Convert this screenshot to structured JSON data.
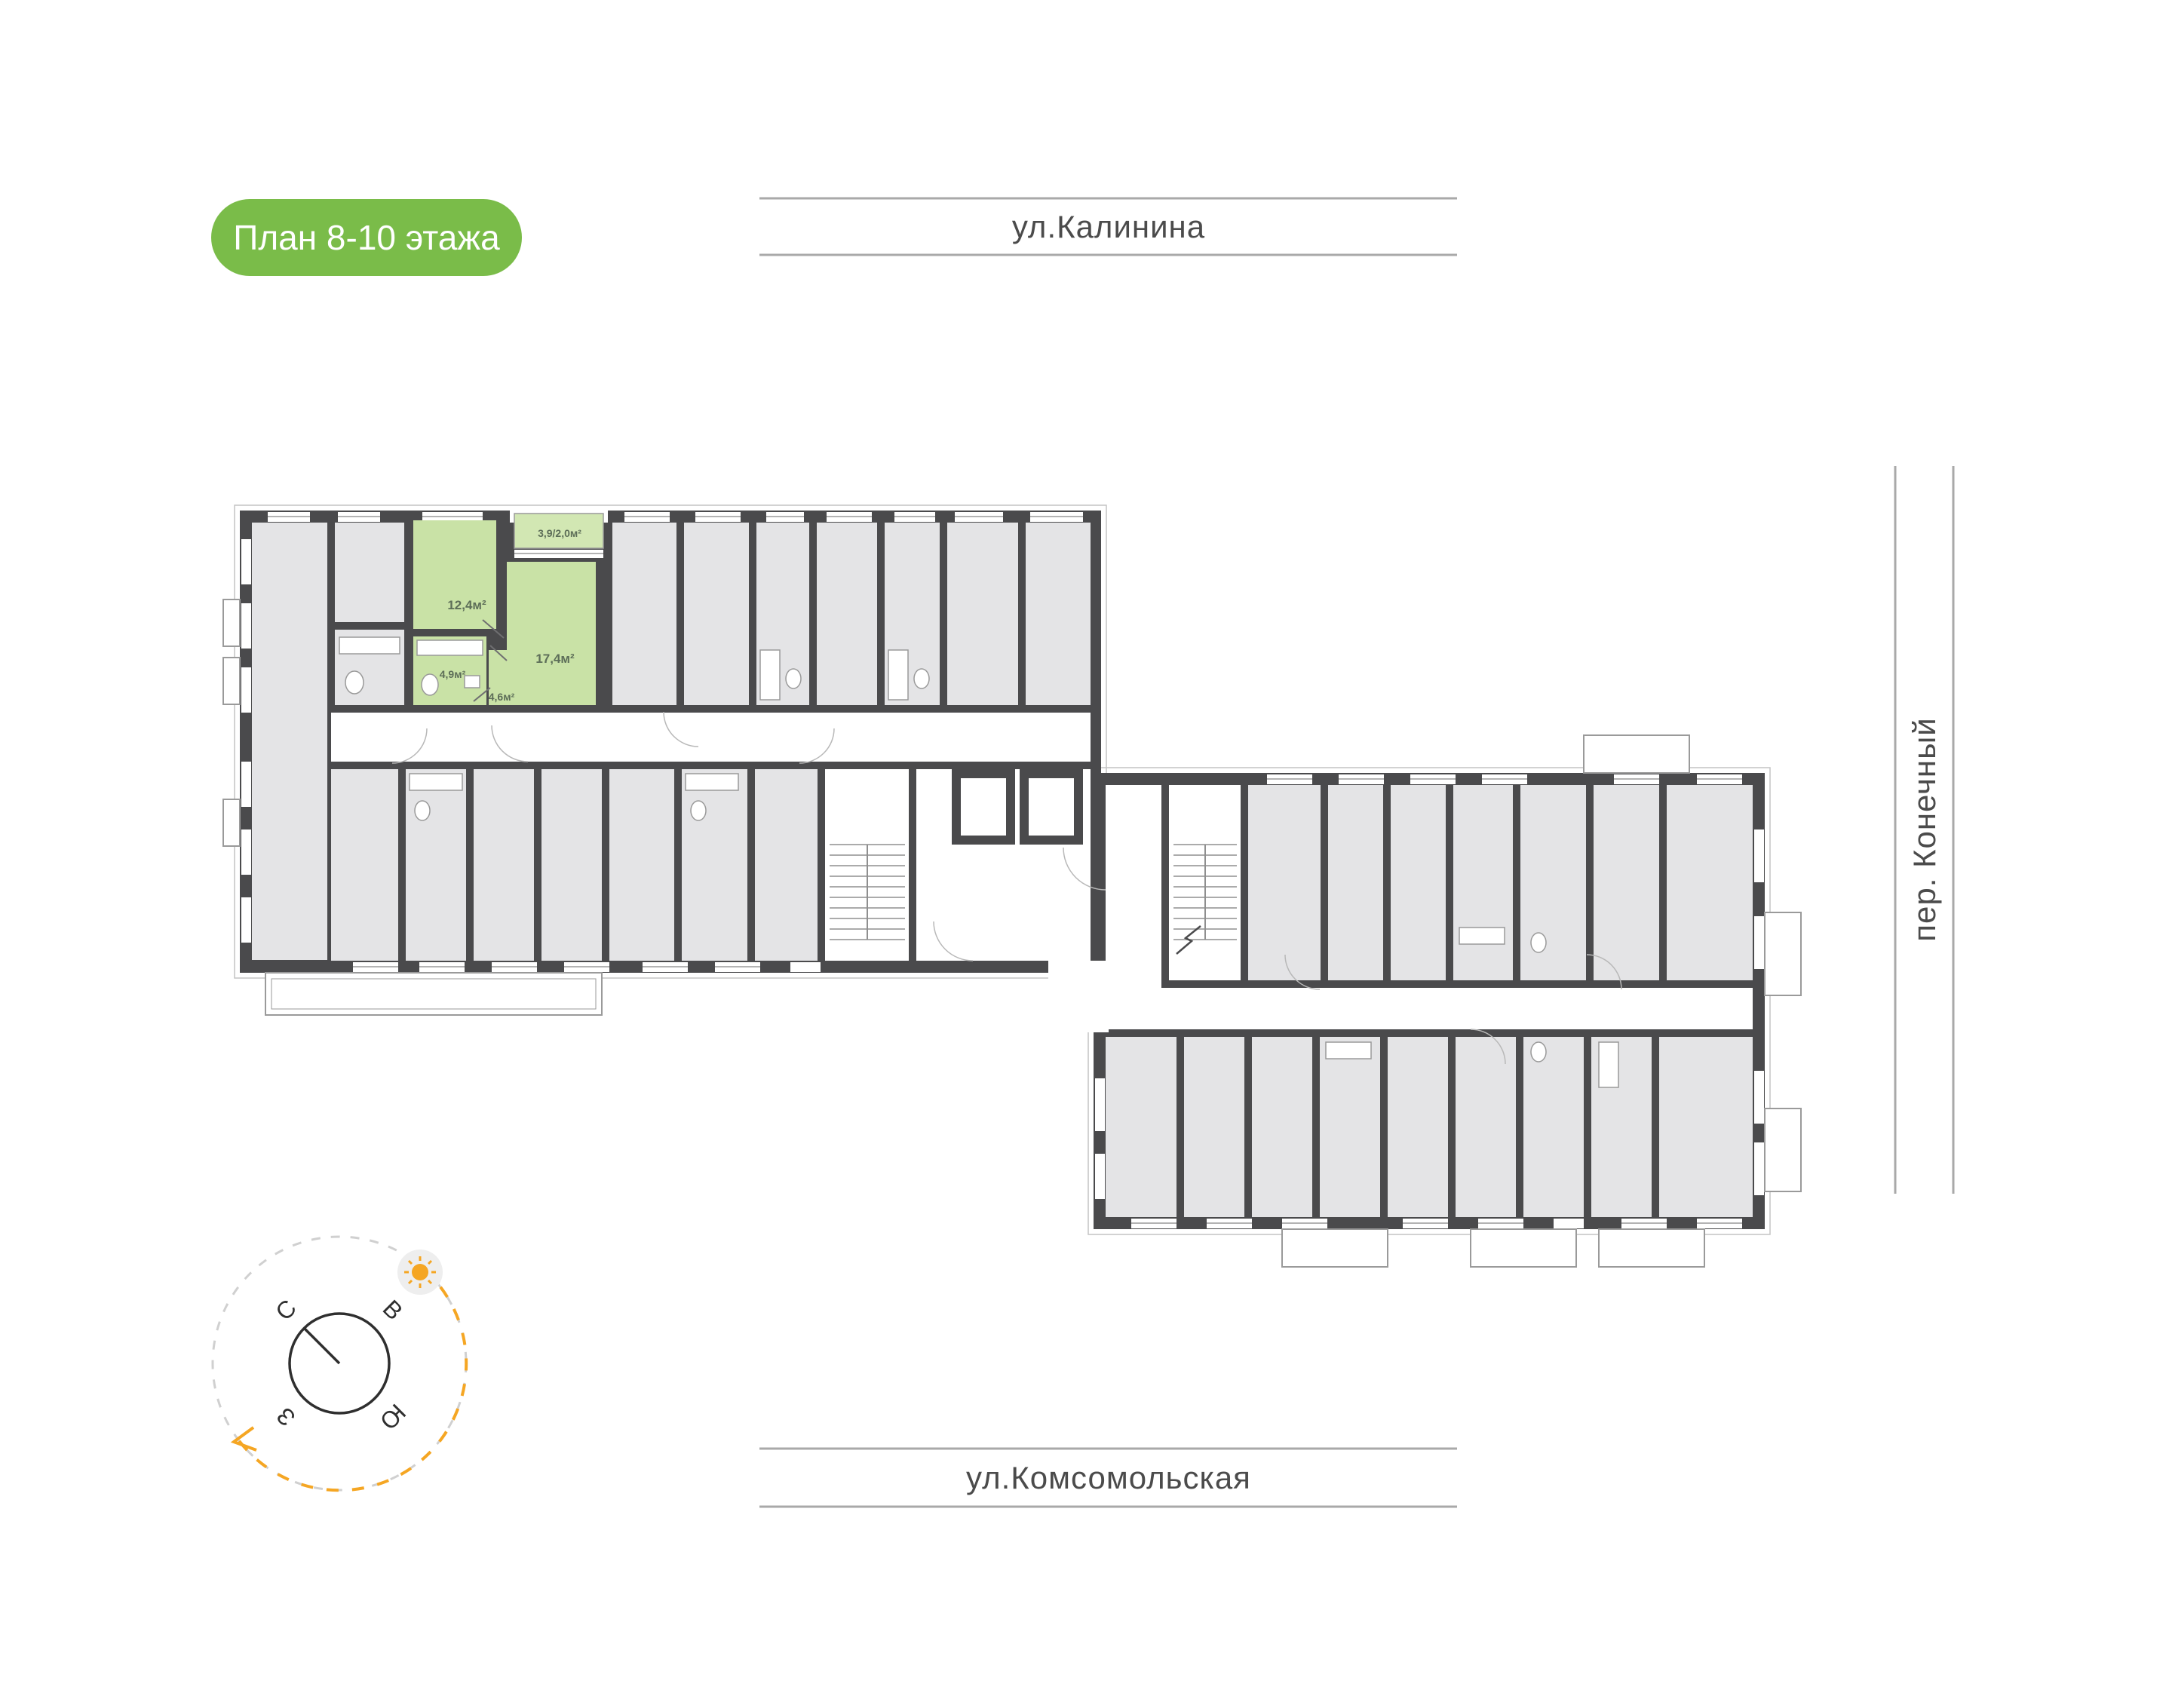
{
  "badge": {
    "label": "План 8-10 этажа",
    "bg": "#7abc49",
    "text_color": "#ffffff"
  },
  "streets": {
    "top": "ул.Калинина",
    "bottom": "ул.Комсомольская",
    "right": "пер. Конечный"
  },
  "compass": {
    "north": "С",
    "east": "В",
    "south": "Ю",
    "west": "З"
  },
  "plan": {
    "floor_range": "8-10",
    "highlighted_unit": {
      "rooms": [
        {
          "name": "living-room",
          "label": "12,4м²",
          "area_m2": 12.4
        },
        {
          "name": "bedroom",
          "label": "17,4м²",
          "area_m2": 17.4
        },
        {
          "name": "bathroom",
          "label": "4,9м²",
          "area_m2": 4.9
        },
        {
          "name": "hallway",
          "label": "4,6м²",
          "area_m2": 4.6
        },
        {
          "name": "balcony",
          "label": "3,9/2,0м²",
          "area_m2": "3,9/2,0"
        }
      ]
    },
    "colors": {
      "wall": "#4a4a4c",
      "room_fill": "#e4e4e6",
      "corridor_fill": "#ffffff",
      "unit_fill": "#c9e2a6",
      "unit_balcony_fill": "#d2e7b3",
      "label_text": "#5d6e58",
      "street_line": "#a9a9a9",
      "street_text": "#4b4b4b",
      "accent_orange": "#f5a623",
      "badge_green": "#7abc49"
    }
  }
}
